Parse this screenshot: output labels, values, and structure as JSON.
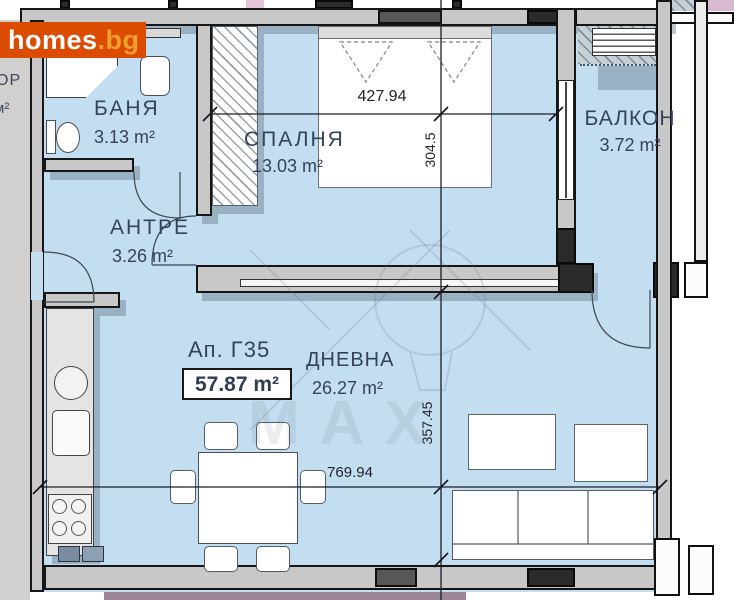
{
  "logo": {
    "main": "homes",
    "suffix": ".bg"
  },
  "neighbor_fragments": {
    "room_name_fragment": "ОР",
    "room_area_fragment": "м²"
  },
  "apartment": {
    "label": "Ап. Г35",
    "total_area": "57.87 m²"
  },
  "rooms": {
    "bathroom": {
      "name": "БАНЯ",
      "area": "3.13 m²"
    },
    "bedroom": {
      "name": "СПАЛНЯ",
      "area": "13.03 m²"
    },
    "balcony": {
      "name": "БАЛКОН",
      "area": "3.72 m²"
    },
    "hallway": {
      "name": "АНТРЕ",
      "area": "3.26 m²"
    },
    "living_room": {
      "name": "ДНЕВНА",
      "area": "26.27 m²"
    }
  },
  "dimensions": {
    "bedroom_width_cm": "427.94",
    "bedroom_depth_cm": "304.5",
    "living_depth_cm": "357.45",
    "apartment_width_cm": "769.94"
  },
  "watermark": "MAX",
  "colors": {
    "interior_fill": "#c3def0",
    "outside_fill": "#d2d0ce",
    "wall_fill": "#c8c8c8",
    "logo_background": "#dc4b02",
    "logo_suffix": "#efa02c",
    "label_text": "#35425c",
    "neighbor_purple": "#9b8596"
  }
}
